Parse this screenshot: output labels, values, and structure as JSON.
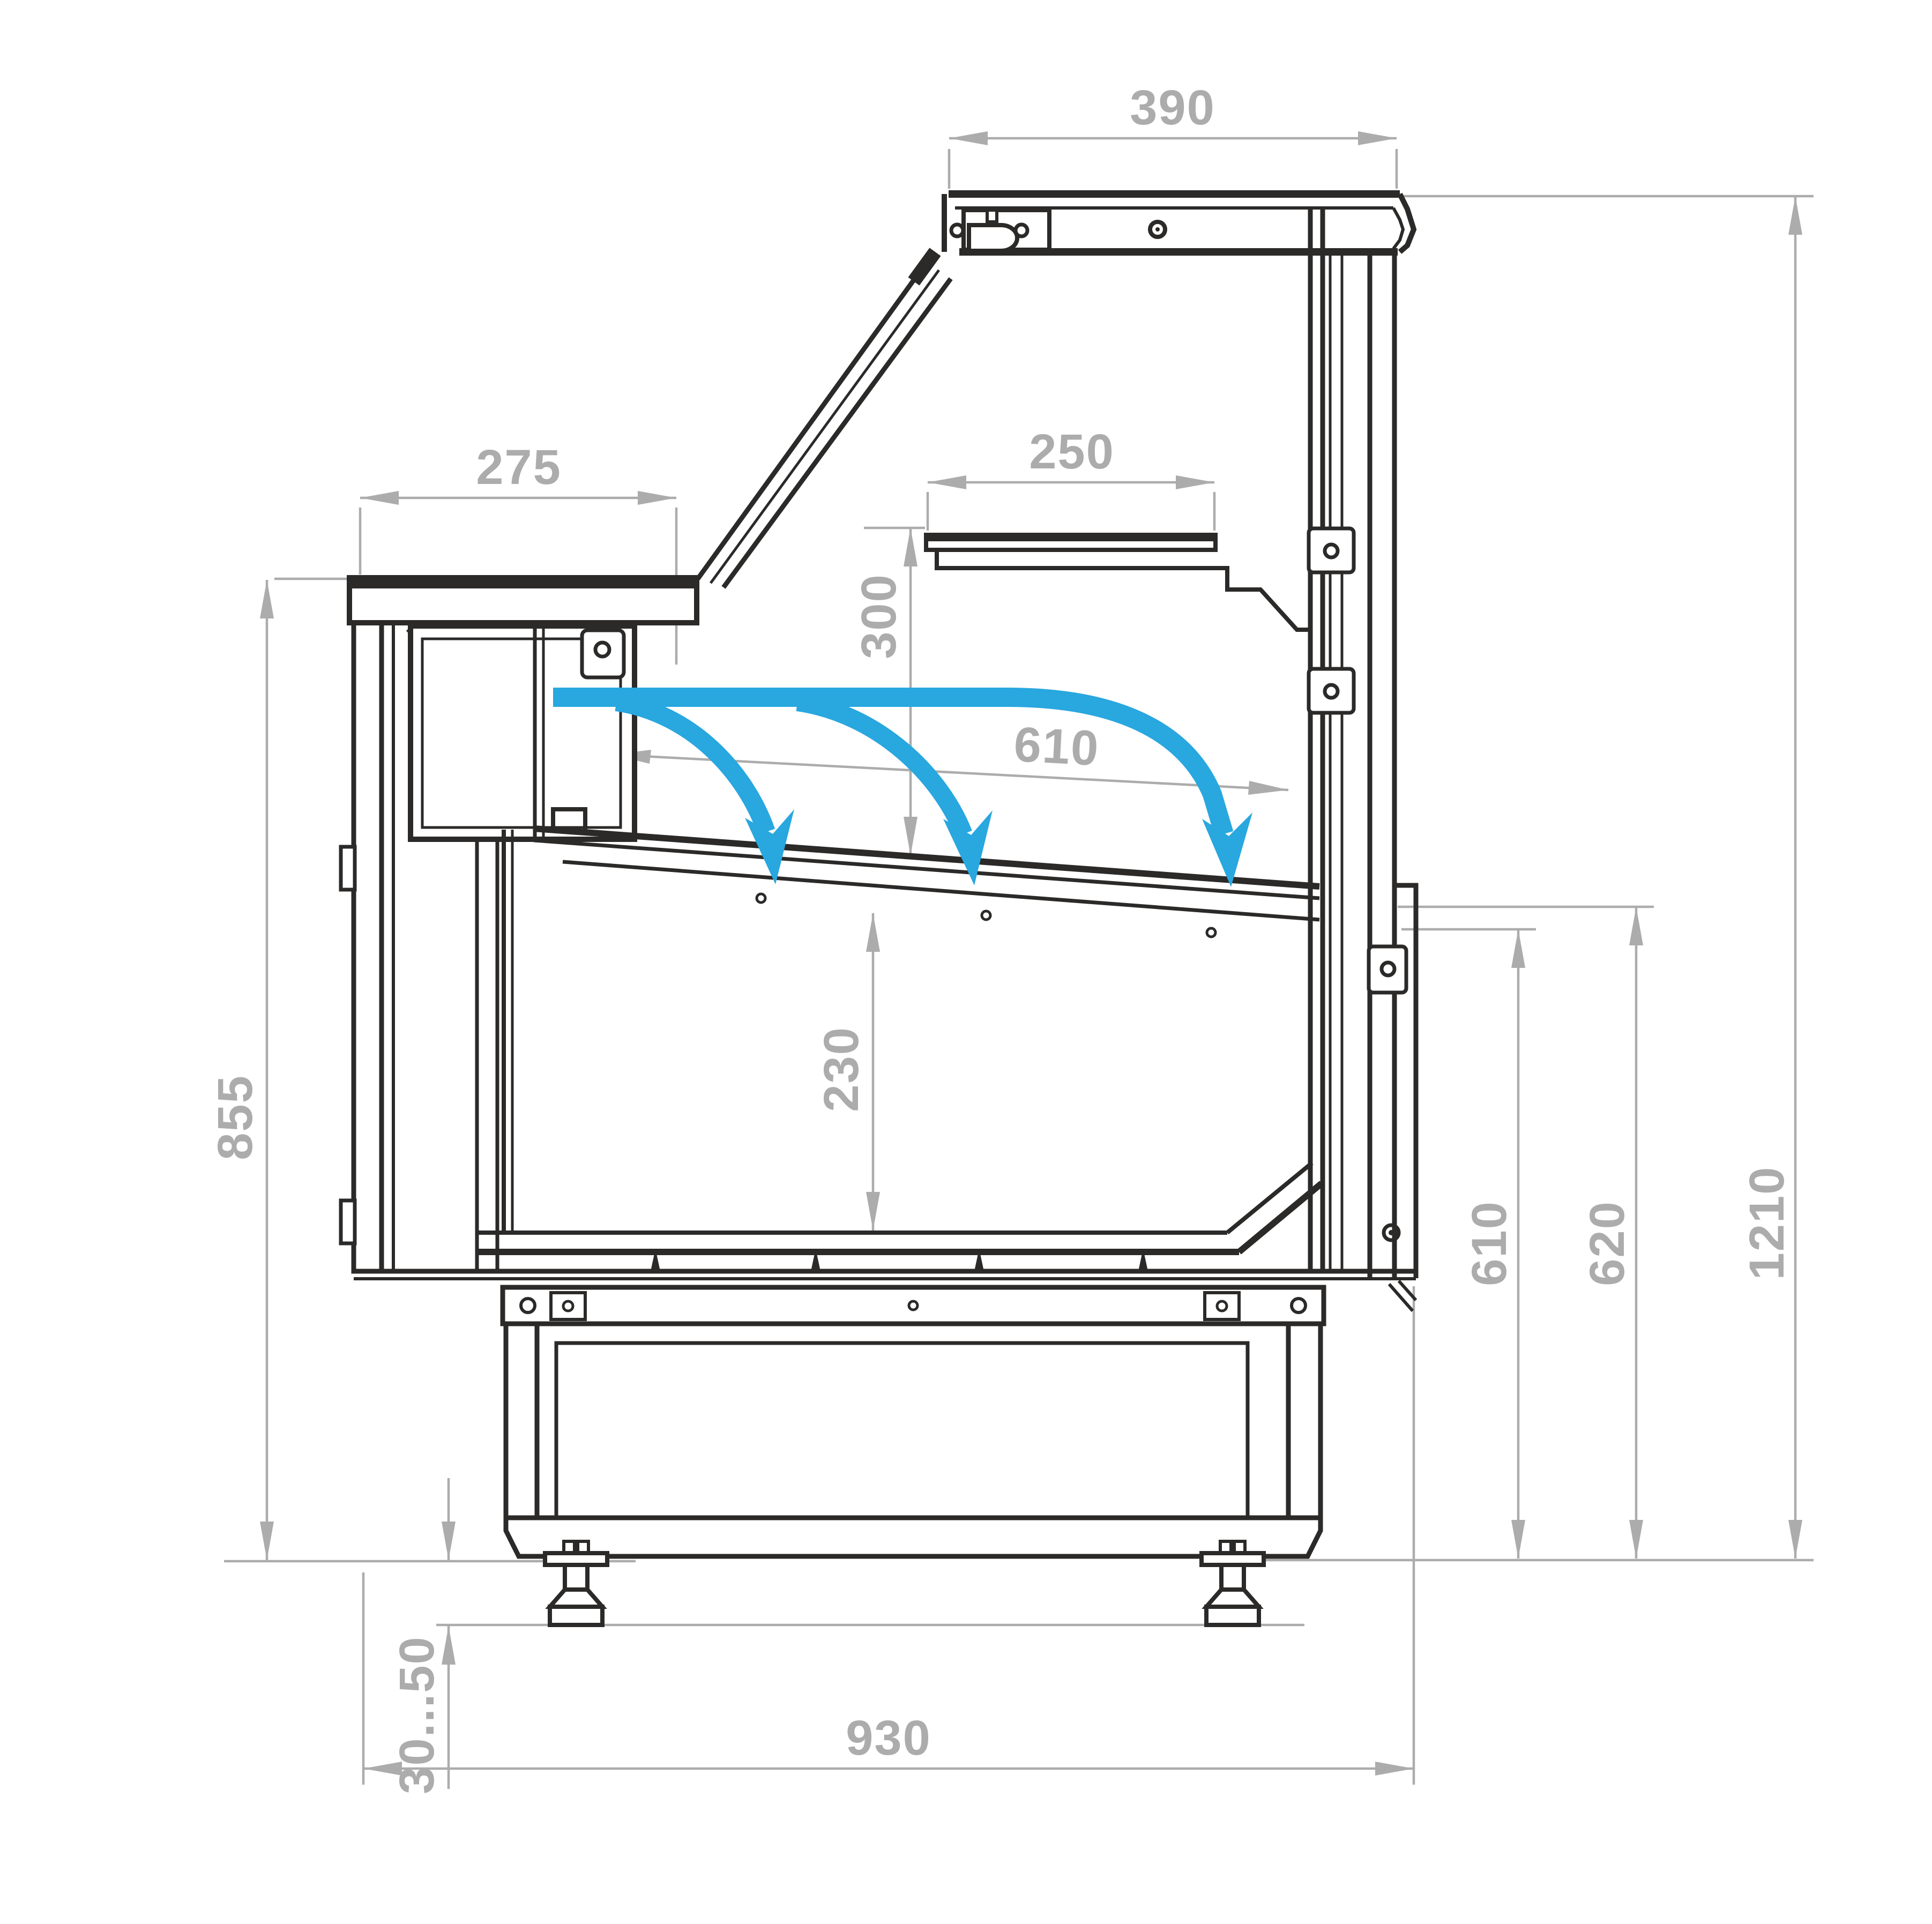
{
  "drawing": {
    "title": "refrigerated-counter-cross-section",
    "colors": {
      "line": "#2B2A29",
      "dimension": "#ACACAC",
      "airflow": "#29A7DF",
      "background": "#FFFFFF"
    },
    "dimensions": {
      "canopy_depth": {
        "label": "390"
      },
      "counter_depth": {
        "label": "275"
      },
      "shelf_depth": {
        "label": "250"
      },
      "shelf_clearance": {
        "label": "300"
      },
      "deck_length": {
        "label": "610"
      },
      "well_depth": {
        "label": "230"
      },
      "counter_height": {
        "label": "855"
      },
      "foot_adjustment": {
        "label": "30...50"
      },
      "base_depth": {
        "label": "930"
      },
      "deck_height": {
        "label": "610"
      },
      "rail_height": {
        "label": "620"
      },
      "total_height": {
        "label": "1210"
      }
    }
  }
}
